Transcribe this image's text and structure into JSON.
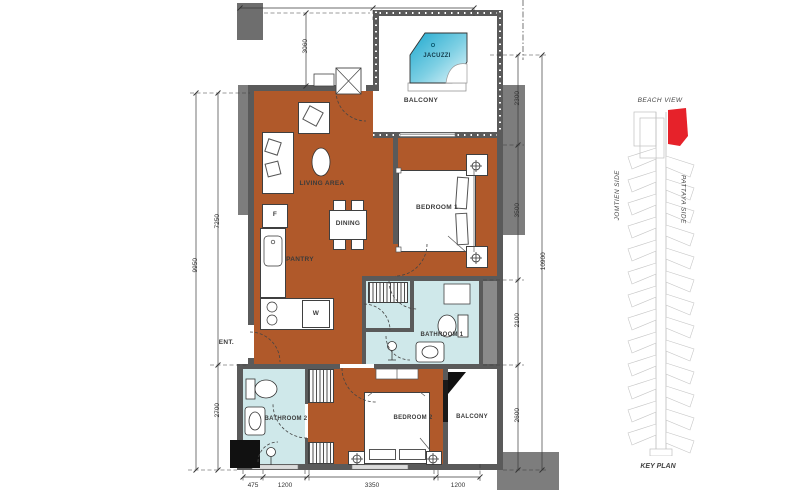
{
  "plan": {
    "labels": {
      "living": "LIVING AREA",
      "dining": "DINING",
      "pantry": "PANTRY",
      "entrance": "ENT.",
      "bedroom1": "BEDROOM 1",
      "bathroom1": "BATHROOM 1",
      "bedroom2": "BEDROOM 2",
      "bathroom2": "BATHROOM 2",
      "balcony_top": "BALCONY",
      "balcony_bottom": "BALCONY",
      "jacuzzi": "JACUZZI",
      "fridge": "F",
      "washer": "W"
    },
    "dimensions": {
      "left_outer": "9950",
      "left_upper": "7250",
      "left_lower": "2700",
      "void_height": "3060",
      "right_segments": [
        "2300",
        "3500",
        "2100",
        "2600"
      ],
      "right_total": "10900",
      "bottom_segments": [
        "475",
        "1200",
        "3350",
        "1200"
      ],
      "top_segments": [
        "2850",
        "2700"
      ]
    }
  },
  "keyplan": {
    "beach_view": "BEACH VIEW",
    "left_side": "JOMTIEN SIDE",
    "right_side": "PATTAYA SIDE",
    "title": "KEY PLAN"
  },
  "colors": {
    "floor": "#b0592a",
    "wet_room": "#cfe8ea",
    "wall": "#5a5a5a",
    "outside": "#7d7d7d",
    "jacuzzi_fill": "#2fb3d6",
    "unit_highlight": "#e6222a"
  }
}
